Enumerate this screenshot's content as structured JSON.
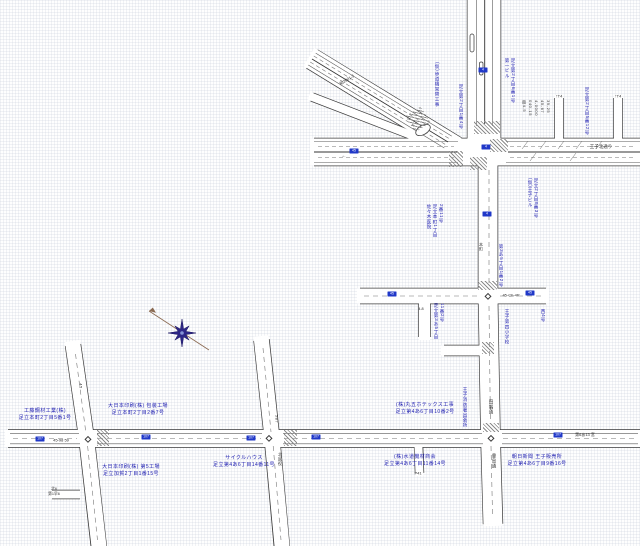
{
  "map": {
    "kind": "cad-road-register-map",
    "canvas": {
      "width": 640,
      "height": 546
    }
  },
  "colors": {
    "road_outline": "#3c3c3c",
    "road_fill": "#ffffff",
    "label_blue": "#1c1cb0",
    "shield_blue": "#2038c8",
    "compass_star": "#2d2687",
    "compass_needle": "#8a6a52",
    "background": "#fefefe"
  },
  "compass": {
    "type": "eight-point-star-with-needle",
    "x": 182,
    "y": 333
  },
  "labels": {
    "businesses": [
      {
        "x": 45,
        "y": 408,
        "lines": [
          "工藤鋼材工業(株)",
          "足立本町2丁目5番1号"
        ]
      },
      {
        "x": 138,
        "y": 403,
        "lines": [
          "大日本印刷(株) 包装工場",
          "足立本町2丁目2番7号"
        ]
      },
      {
        "x": 131,
        "y": 464,
        "lines": [
          "大日本印刷(株) 第5工場",
          "足立加賀2丁目1番15号"
        ]
      },
      {
        "x": 244,
        "y": 455,
        "lines": [
          "サイクルハウス",
          "足立第4あ6丁目14番11号"
        ]
      },
      {
        "x": 425,
        "y": 402,
        "lines": [
          "(株)丸五ホテックス工事",
          "足立第4あ6丁目10番2号"
        ]
      },
      {
        "x": 415,
        "y": 454,
        "lines": [
          "(株)水道機材商会",
          "足立第4あ6丁目11番14号"
        ]
      },
      {
        "x": 537,
        "y": 454,
        "lines": [
          "朝日新聞 王子販売所",
          "足立第4あ6丁目9番16号"
        ]
      }
    ],
    "vertical_labels": [
      {
        "x": 435,
        "y": 62,
        "columns": [
          "(仮)歩道橋架替工事"
        ]
      },
      {
        "x": 459,
        "y": 84,
        "columns": [
          "足立第2丁目1番4号"
        ]
      },
      {
        "x": 585,
        "y": 87,
        "columns": [
          "足立第2丁目5番12号"
        ]
      },
      {
        "x": 505,
        "y": 58,
        "columns": [
          "第一ビル",
          "足立第2丁目6番1号"
        ]
      },
      {
        "x": 427,
        "y": 204,
        "columns": [
          "佐々木医院",
          "足立本町1丁目",
          "2番11号"
        ]
      },
      {
        "x": 499,
        "y": 244,
        "columns": [
          "第3あ5丁目1番2号"
        ]
      },
      {
        "x": 528,
        "y": 178,
        "columns": [
          "(仮)王子ビル",
          "足立2丁目8番3号"
        ]
      },
      {
        "x": 505,
        "y": 309,
        "columns": [
          "王子第四小学校"
        ]
      },
      {
        "x": 541,
        "y": 309,
        "columns": [
          "西4号"
        ]
      },
      {
        "x": 463,
        "y": 387,
        "columns": [
          "王子消防署出張所"
        ]
      },
      {
        "x": 434,
        "y": 303,
        "columns": [
          "足立第3あ5丁目",
          "11番2号"
        ]
      },
      {
        "x": 522,
        "y": 100,
        "ink": "black",
        "columns": [
          "南4-5",
          "040-15",
          "4-0000",
          "45-67",
          "39-25"
        ]
      }
    ],
    "road_texts": [
      {
        "text": "王子北通り",
        "x": 601,
        "y": 147
      },
      {
        "text": "45-98 59",
        "x": 61,
        "y": 440,
        "size": 4
      },
      {
        "text": "第6あ13 宮",
        "x": 585,
        "y": 435,
        "size": 4
      },
      {
        "text": "45-Ch-4P",
        "x": 511,
        "y": 295,
        "size": 4
      },
      {
        "text": "4.8",
        "x": 421,
        "y": 309,
        "size": 3.8
      },
      {
        "text": "紀2001-5",
        "x": 347,
        "y": 80,
        "rot": -31,
        "size": 4
      },
      {
        "text": "田端通",
        "x": 491,
        "y": 407,
        "vertical": true
      },
      {
        "text": "豊島通",
        "x": 494,
        "y": 461,
        "vertical": true
      },
      {
        "text": "587",
        "x": 277,
        "y": 419,
        "vertical": true,
        "size": 4
      },
      {
        "text": "北区役",
        "x": 280,
        "y": 459,
        "vertical": true,
        "size": 4
      },
      {
        "text": "45",
        "x": 81,
        "y": 386,
        "vertical": true,
        "size": 4
      },
      {
        "text": "本町",
        "x": 481,
        "y": 247,
        "vertical": true,
        "size": 4
      },
      {
        "text": "↑T4",
        "x": 559,
        "y": 96,
        "size": 4
      },
      {
        "text": "↑T4",
        "x": 618,
        "y": 96,
        "size": 4
      },
      {
        "text": "P41",
        "x": 418,
        "y": 473,
        "size": 4
      },
      {
        "text": "←",
        "x": 344,
        "y": 156,
        "size": 5
      }
    ],
    "micro_labels": [
      {
        "x": 54,
        "y": 487,
        "lines": [
          "北6",
          "第1早6"
        ]
      }
    ]
  },
  "markers": {
    "route_shields": [
      {
        "x": 40,
        "y": 439,
        "label": "107"
      },
      {
        "x": 146,
        "y": 437,
        "label": "107"
      },
      {
        "x": 251,
        "y": 438,
        "label": "107"
      },
      {
        "x": 316,
        "y": 437,
        "label": "107"
      },
      {
        "x": 558,
        "y": 435,
        "label": "107"
      },
      {
        "x": 392,
        "y": 294,
        "label": "45"
      },
      {
        "x": 530,
        "y": 293,
        "label": "45"
      },
      {
        "x": 483,
        "y": 70,
        "label": "4"
      },
      {
        "x": 486,
        "y": 147,
        "label": "4"
      },
      {
        "x": 487,
        "y": 214,
        "label": "4"
      },
      {
        "x": 354,
        "y": 151,
        "label": "45"
      }
    ],
    "intersection_diamonds": [
      {
        "x": 88,
        "y": 439
      },
      {
        "x": 269,
        "y": 438
      },
      {
        "x": 491,
        "y": 438
      },
      {
        "x": 488,
        "y": 296
      }
    ],
    "crosswalks": [
      {
        "x": 449,
        "y": 151,
        "w": 14,
        "h": 16
      },
      {
        "x": 490,
        "y": 139,
        "w": 18,
        "h": 13
      },
      {
        "x": 470,
        "y": 157,
        "w": 17,
        "h": 13
      },
      {
        "x": 409,
        "y": 110,
        "w": 18,
        "h": 19,
        "rot": -32
      },
      {
        "x": 478,
        "y": 281,
        "w": 19,
        "h": 9
      },
      {
        "x": 483,
        "y": 423,
        "w": 16,
        "h": 9
      },
      {
        "x": 284,
        "y": 430,
        "w": 13,
        "h": 16
      },
      {
        "x": 97,
        "y": 430,
        "w": 12,
        "h": 16
      },
      {
        "x": 474,
        "y": 121,
        "w": 26,
        "h": 13
      },
      {
        "x": 482,
        "y": 342,
        "w": 12,
        "h": 12
      }
    ]
  }
}
